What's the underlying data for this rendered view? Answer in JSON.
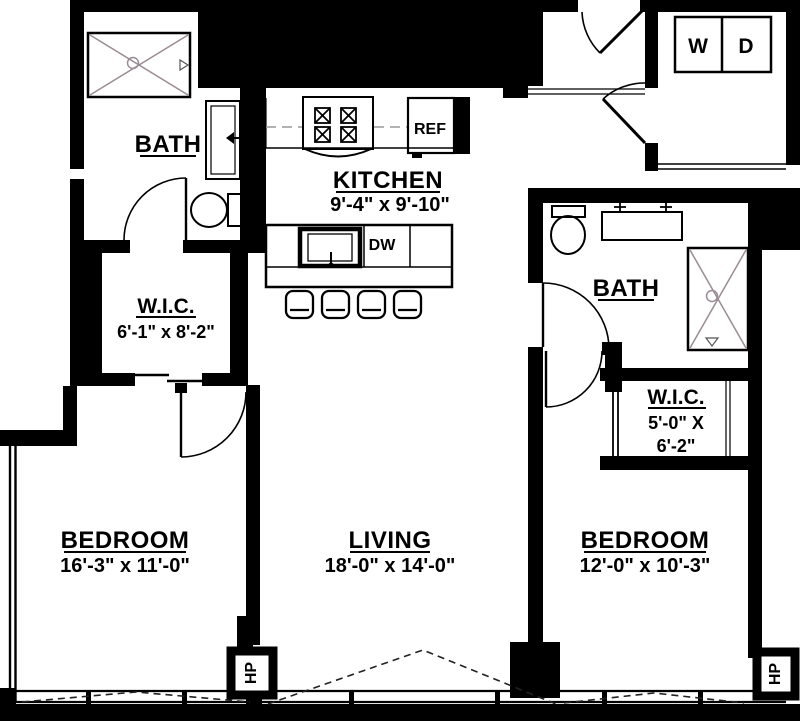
{
  "plan": {
    "rooms": {
      "bath1": {
        "name": "BATH"
      },
      "kitchen": {
        "name": "KITCHEN",
        "dims": "9'-4\" x 9'-10\""
      },
      "wic1": {
        "name": "W.I.C.",
        "dims": "6'-1\" x 8'-2\""
      },
      "bath2": {
        "name": "BATH"
      },
      "wic2": {
        "name": "W.I.C.",
        "dims_line1": "5'-0\" X",
        "dims_line2": "6'-2\""
      },
      "bedroom1": {
        "name": "BEDROOM",
        "dims": "16'-3\" x 11'-0\""
      },
      "living": {
        "name": "LIVING",
        "dims": "18'-0\" x 14'-0\""
      },
      "bedroom2": {
        "name": "BEDROOM",
        "dims": "12'-0\" x 10'-3\""
      }
    },
    "appliances": {
      "refrigerator": "REF",
      "dishwasher": "DW",
      "washer": "W",
      "dryer": "D",
      "heat_pump_1": "HP",
      "heat_pump_2": "HP"
    },
    "colors": {
      "wall": "#000000",
      "background": "#ffffff",
      "tile_accent": "#9b8b94"
    }
  }
}
